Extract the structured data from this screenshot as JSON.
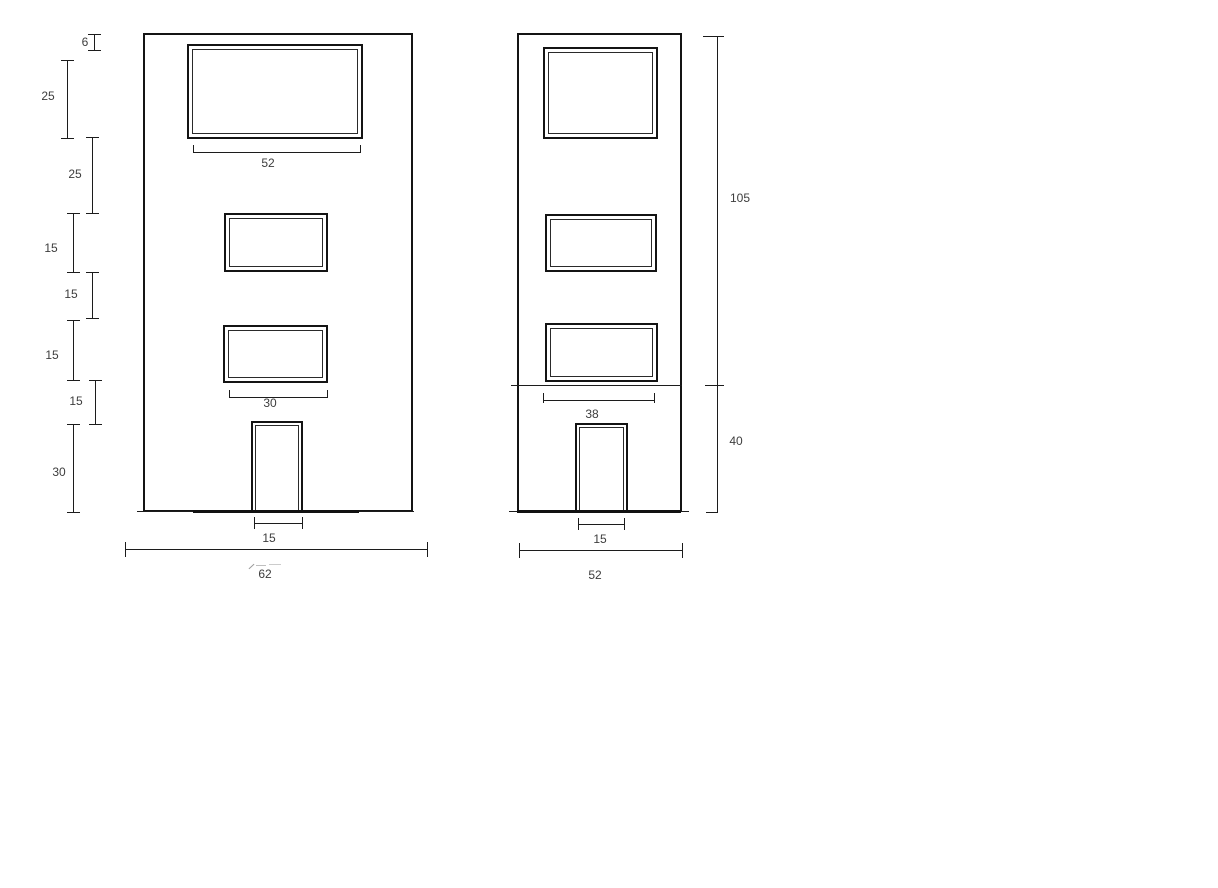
{
  "left_elevation": {
    "height_dims": [
      {
        "value": "6"
      },
      {
        "value": "25"
      },
      {
        "value": "25"
      },
      {
        "value": "15"
      },
      {
        "value": "15"
      },
      {
        "value": "15"
      },
      {
        "value": "15"
      },
      {
        "value": "30"
      }
    ],
    "top_window_width": "52",
    "mid_window_width": "30",
    "door_width": "15",
    "overall_width": "62"
  },
  "right_elevation": {
    "window_width": "38",
    "door_width": "15",
    "overall_width": "52",
    "upper_height": "105",
    "lower_height": "40"
  }
}
